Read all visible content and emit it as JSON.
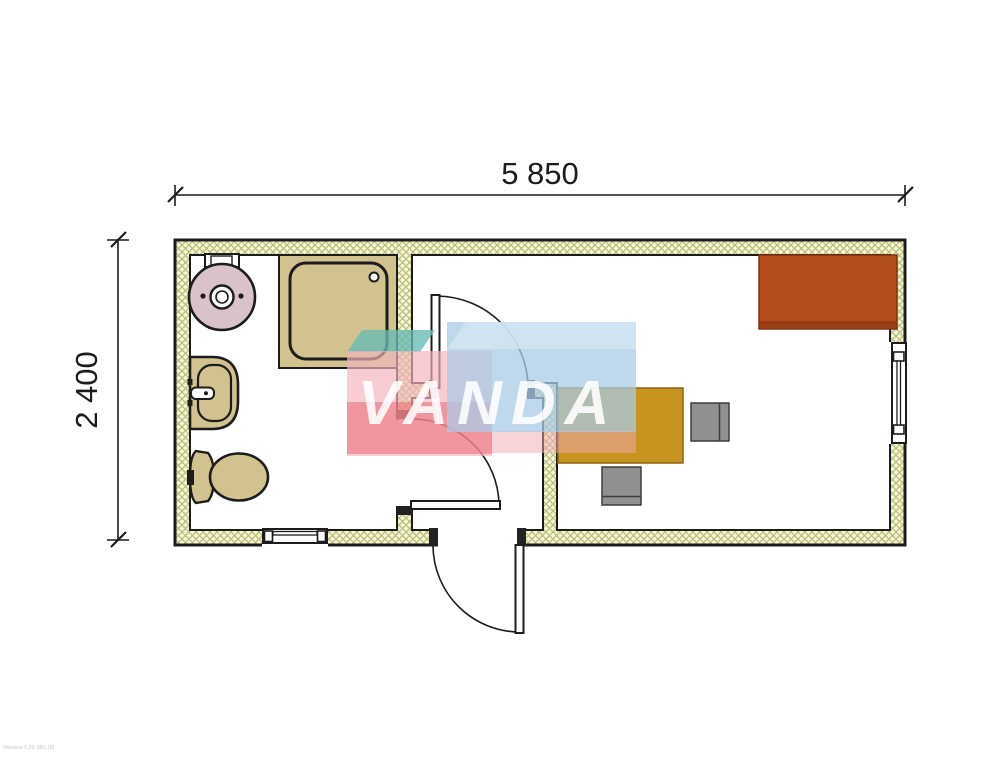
{
  "document": {
    "type": "floor-plan-container-office-with-wc",
    "footer_note": "Window 0,55 (85) (8)"
  },
  "dimensions": {
    "top_width": "5 850",
    "left_height": "2 400"
  },
  "watermark": {
    "text": "VANDA"
  },
  "rooms": {
    "bathroom": {
      "fixtures": [
        "water-heater",
        "shower-tray",
        "washbasin",
        "toilet"
      ],
      "window": "bottom-wall-window"
    },
    "entrance_hall": {
      "doors": [
        "entrance-door",
        "bathroom-door",
        "office-door"
      ]
    },
    "office": {
      "furniture": [
        "desk",
        "chair-right",
        "chair-front",
        "cabinet"
      ],
      "window": "right-wall-window"
    }
  },
  "colors": {
    "wall_fill": "#f6f4da",
    "wall_hatch": "#b9bd72",
    "outline": "#1c1c1c",
    "boiler_pink": "#d9c2c9",
    "fixture_tan": "#d2c28f",
    "desk_gold": "#c8941f",
    "chair_gray": "#909090",
    "cabinet_orange": "#b54c1c",
    "cabinet_orange_dark": "#9c3e13",
    "wm_teal": "rgba(103,186,181,0.78)",
    "wm_pink": "rgba(243,180,188,0.68)",
    "wm_red": "rgba(236,95,105,0.5)",
    "wm_blue": "rgba(170,203,230,0.75)",
    "wm_blue_light": "rgba(213,230,243,0.8)",
    "wm_under_red": "rgba(242,170,180,0.5)",
    "wm_text": "rgba(255,255,255,0.88)"
  }
}
